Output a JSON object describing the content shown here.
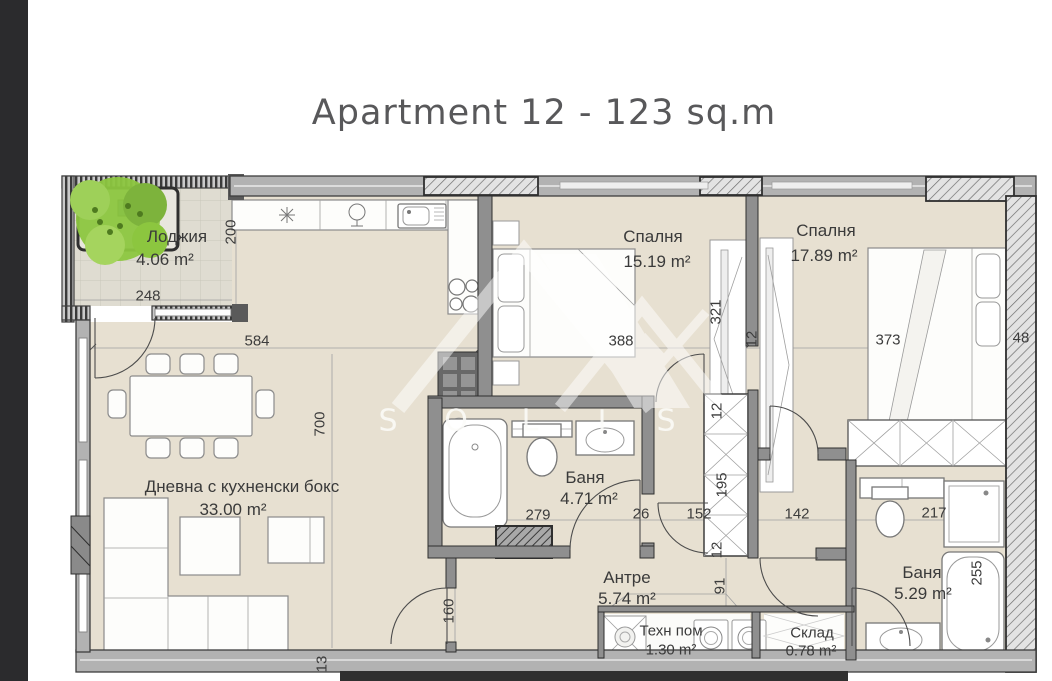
{
  "title": "Apartment 12 - 123 sq.m",
  "watermark": {
    "l1": "S",
    "l2": "O",
    "l3": "L",
    "l4": "I",
    "l5": "S"
  },
  "rooms": {
    "loggia": {
      "name": "Лоджия",
      "area": "4.06 m²"
    },
    "living": {
      "name": "Дневна с кухненски бокс",
      "area": "33.00 m²"
    },
    "bedroom1": {
      "name": "Спалня",
      "area": "15.19 m²"
    },
    "bedroom2": {
      "name": "Спалня",
      "area": "17.89 m²"
    },
    "bath1": {
      "name": "Баня",
      "area": "4.71 m²"
    },
    "hall": {
      "name": "Антре",
      "area": "5.74 m²"
    },
    "tech": {
      "name": "Техн пом",
      "area": "1.30 m²"
    },
    "storage": {
      "name": "Склад",
      "area": "0.78 m²"
    },
    "bath2": {
      "name": "Баня",
      "area": "5.29 m²"
    }
  },
  "dims": {
    "loggia_width": "248",
    "loggia_height": "200",
    "living_width": "584",
    "living_height": "700",
    "living_wall": "13",
    "hall_left": "160",
    "hall_mid": "91",
    "bedroom1_width": "388",
    "bedroom1_height": "321",
    "wall_bedrooms": "12",
    "bedroom2_width": "373",
    "right_wall": "48",
    "bath1_width": "279",
    "bath1_wall": "26",
    "corridor_left": "152",
    "corridor_right": "142",
    "closet_height": "195",
    "closet_wall_top": "12",
    "closet_wall_bottom": "12",
    "bath2_width": "217",
    "bath2_height": "255"
  },
  "colors": {
    "floor": "#e7e0d1",
    "wall": "#b2b2b2",
    "tree": "#8cc63f",
    "title_text": "#58585a"
  }
}
